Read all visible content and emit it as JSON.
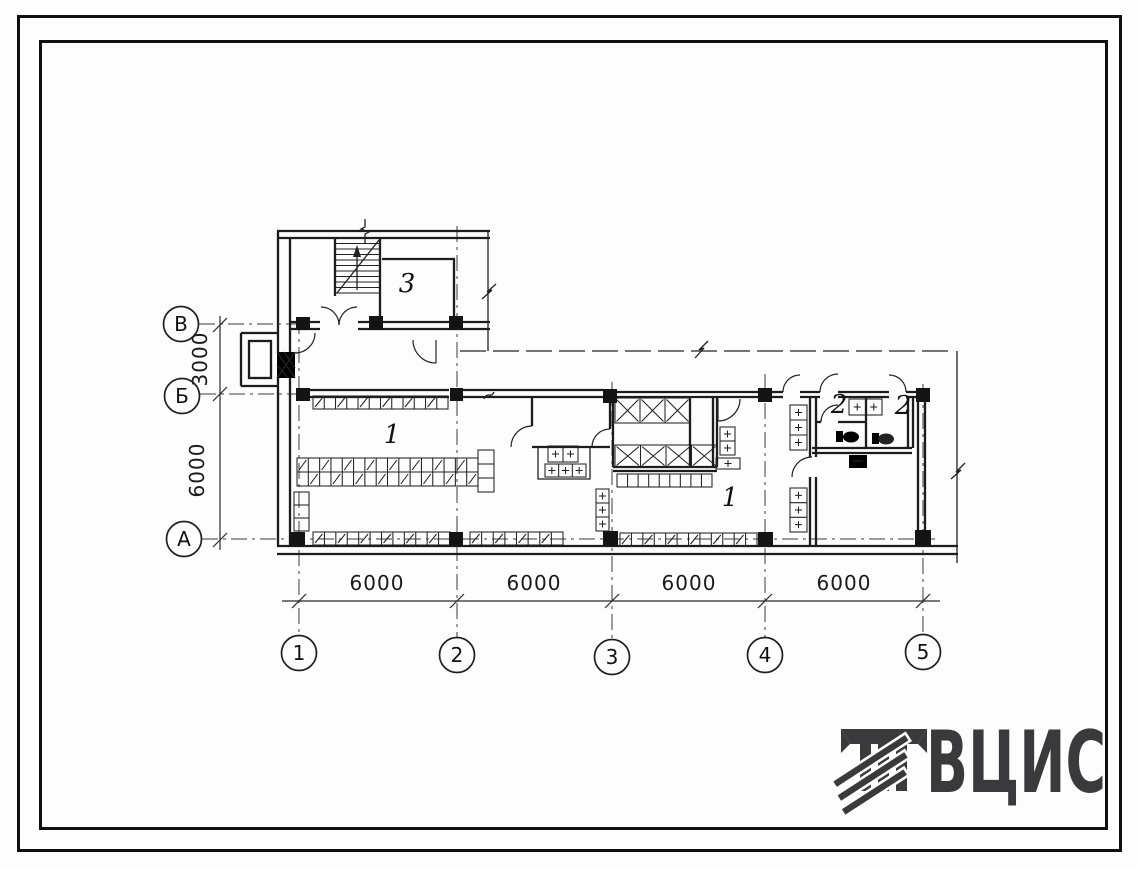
{
  "drawing": {
    "axis_rows": [
      "В",
      "Б",
      "А"
    ],
    "axis_cols": [
      "1",
      "2",
      "3",
      "4",
      "5"
    ],
    "dims_bottom": [
      "6000",
      "6000",
      "6000",
      "6000"
    ],
    "dim_left": [
      "3000",
      "6000"
    ],
    "rooms": [
      "3",
      "1",
      "1",
      "2",
      "2"
    ]
  },
  "logo": {
    "text": "ВЦИС",
    "color": "#3a3a3d"
  },
  "colors": {
    "ink": "#1c1c1c",
    "paper": "#fdfdfd"
  }
}
